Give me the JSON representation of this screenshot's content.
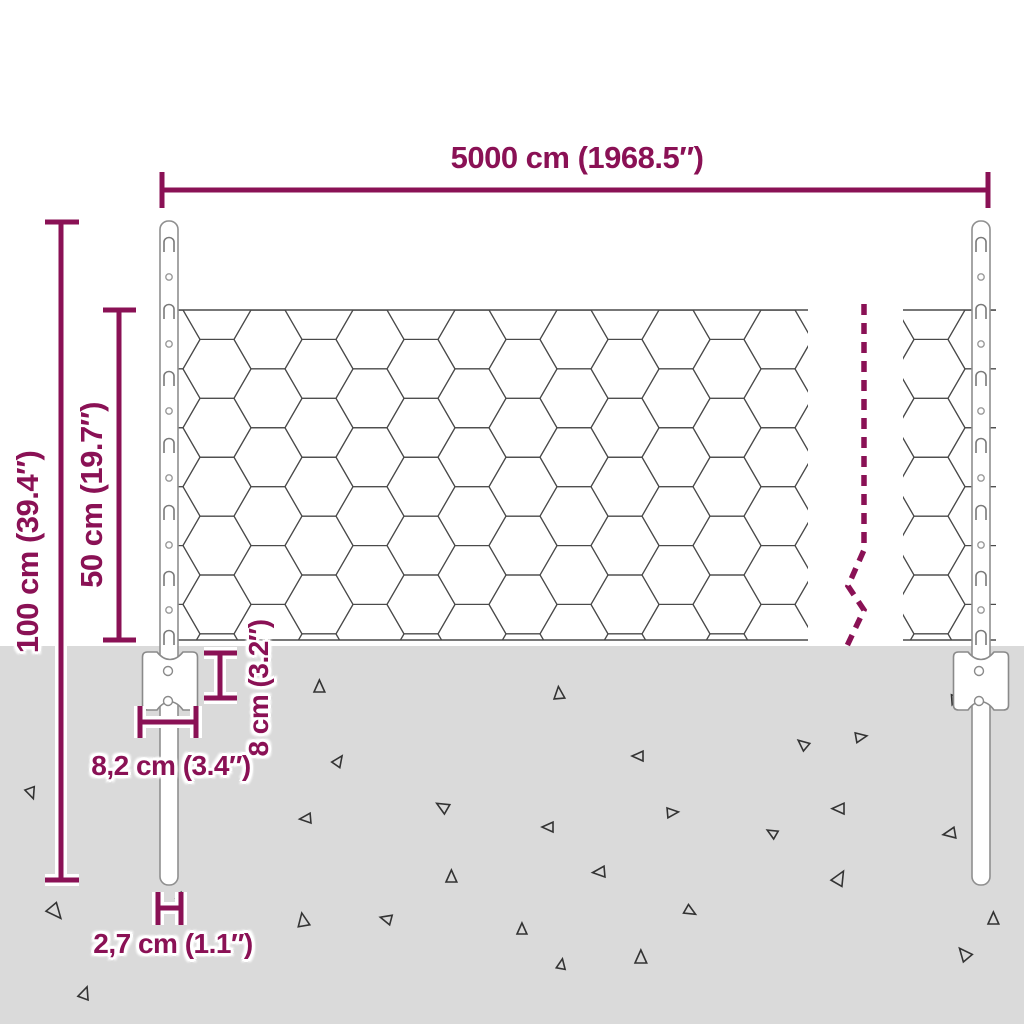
{
  "diagram": {
    "type": "product-dimension-diagram",
    "subject": "wire mesh fence with anchor posts"
  },
  "colors": {
    "accent": "#8A1155",
    "background": "#FFFFFF",
    "ground": "#DADADA",
    "mesh_line": "#4A4A4A",
    "post_outline": "#8F8F8F",
    "texture_mark": "#333333"
  },
  "labels": {
    "total_width": "5000 cm (1968.5″)",
    "total_height": "100 cm (39.4″)",
    "mesh_height": "50 cm (19.7″)",
    "anchor_height": "8 cm (3.2″)",
    "anchor_width": "8,2 cm (3.4″)",
    "post_diameter": "2,7 cm (1.1″)"
  }
}
